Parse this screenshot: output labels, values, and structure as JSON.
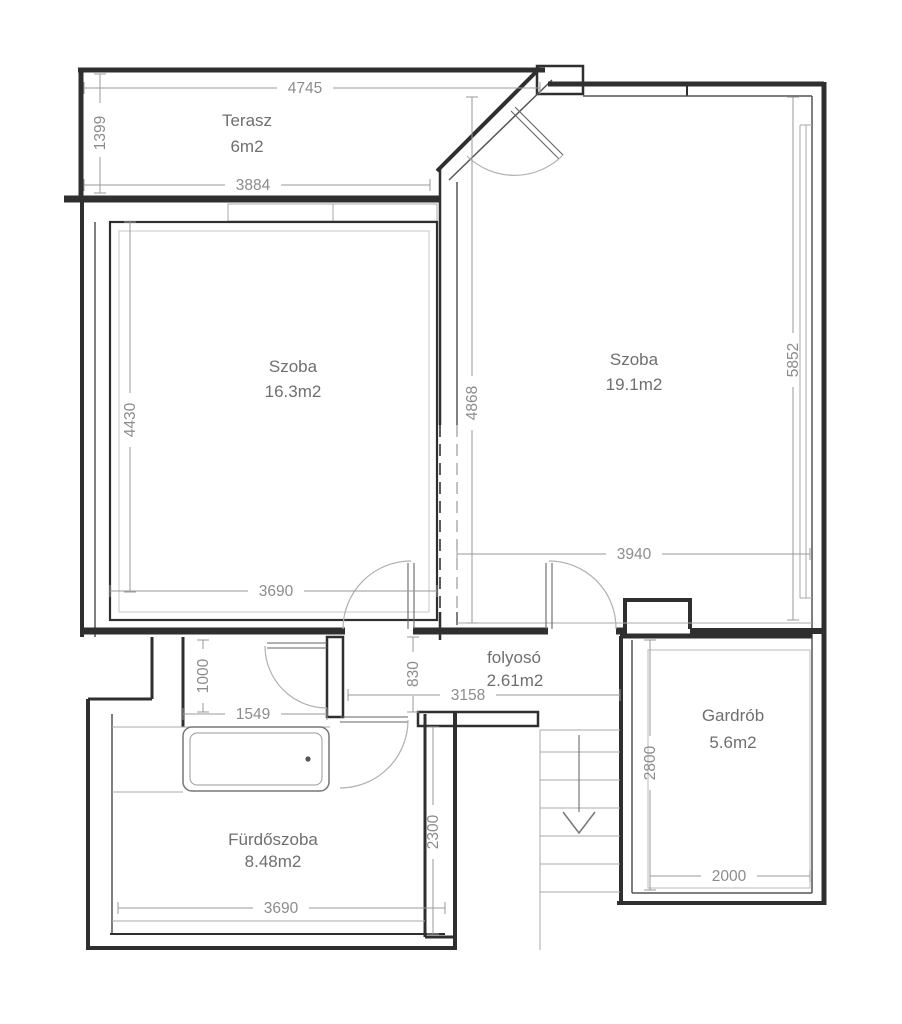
{
  "plan": {
    "title": "apartment-floor-plan",
    "rooms": [
      {
        "name": "Terasz",
        "area": "6m2"
      },
      {
        "name": "Szoba",
        "area": "16.3m2"
      },
      {
        "name": "Szoba",
        "area": "19.1m2"
      },
      {
        "name": "folyosó",
        "area": "2.61m2"
      },
      {
        "name": "Gardrób",
        "area": "5.6m2"
      },
      {
        "name": "Fürdőszoba",
        "area": "8.48m2"
      }
    ],
    "dims": {
      "terrace_width": "4745",
      "terrace_depth": "1399",
      "terrace_window": "3884",
      "room_left_depth": "4430",
      "room_left_width": "3690",
      "partition": "4868",
      "room_right_depth": "5852",
      "room_right_width": "3940",
      "corridor_depth": "830",
      "corridor_width": "3158",
      "niche_depth": "1000",
      "niche_width": "1549",
      "bathroom_depth": "2300",
      "bathroom_width": "3690",
      "wardrobe_depth": "2800",
      "wardrobe_width": "2000"
    },
    "colors": {
      "wall": "#2f2f2f",
      "dim_text": "#8c8c8c",
      "room_text": "#6f6f6f"
    }
  }
}
